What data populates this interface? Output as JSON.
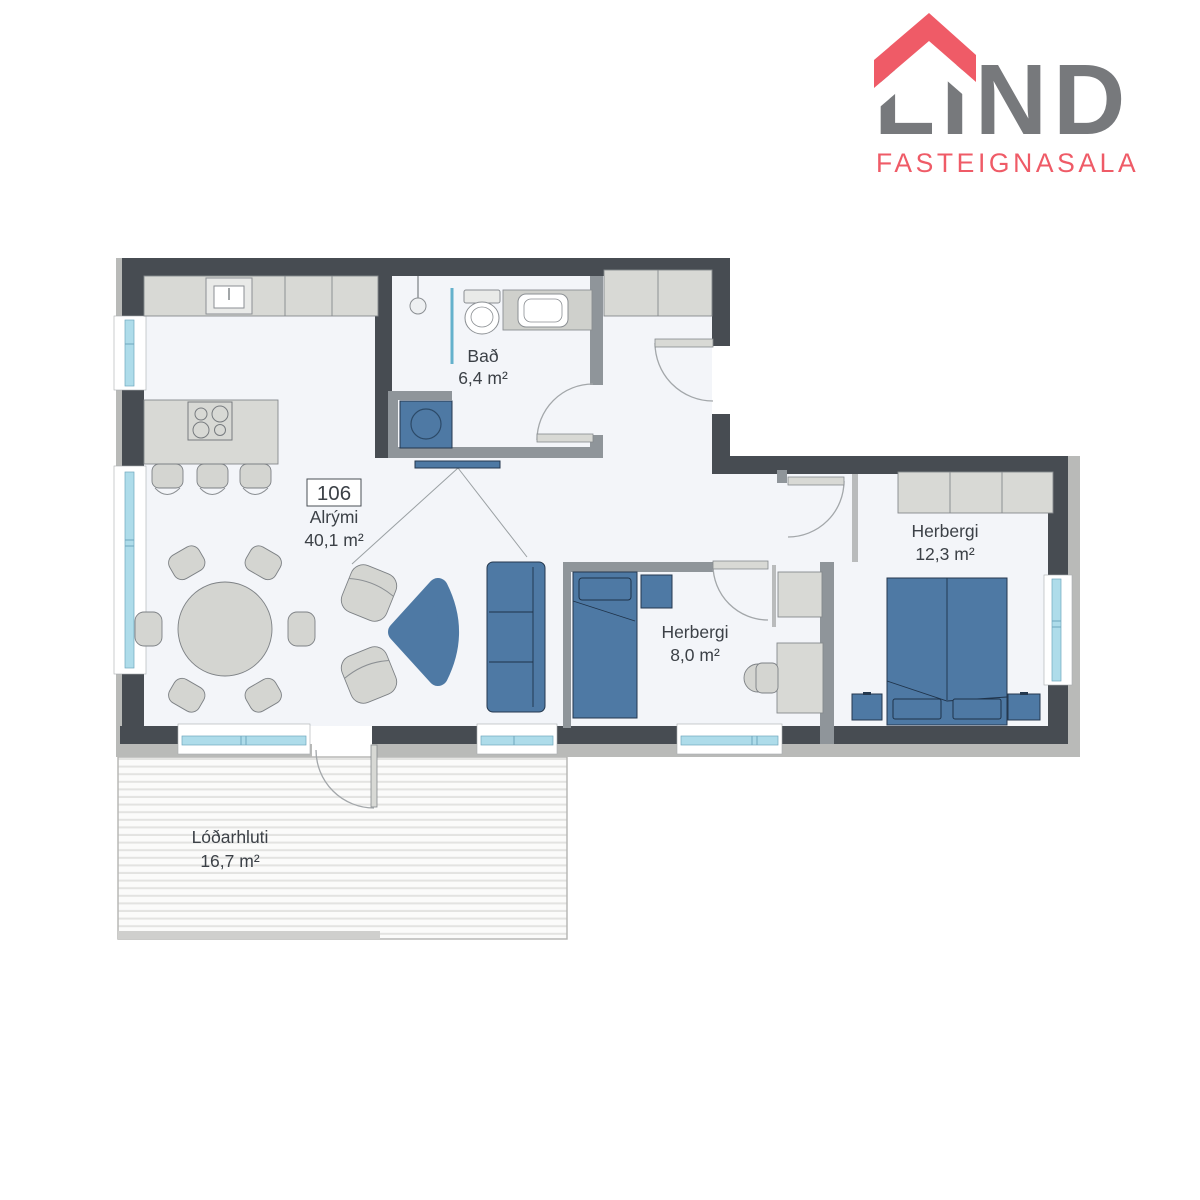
{
  "logo": {
    "name": "LIND",
    "subtitle": "FASTEIGNASALA",
    "brand_red": "#ef5b67",
    "brand_gray": "#77797c"
  },
  "unit": {
    "number": "106"
  },
  "rooms": {
    "bath": {
      "name": "Bað",
      "area": "6,4 m²"
    },
    "living": {
      "name": "Alrými",
      "area": "40,1 m²"
    },
    "bedroom_small": {
      "name": "Herbergi",
      "area": "8,0 m²"
    },
    "bedroom_large": {
      "name": "Herbergi",
      "area": "12,3 m²"
    },
    "patio": {
      "name": "Lóðarhluti",
      "area": "16,7 m²"
    }
  },
  "colors": {
    "exterior_wall": "#474c52",
    "interior_wall": "#8f959a",
    "floor": "#f3f5f9",
    "furniture_gray": "#d8d9d5",
    "furniture_blue": "#4e79a4",
    "window_glass": "#aedcea",
    "label_text": "#3c4147"
  }
}
